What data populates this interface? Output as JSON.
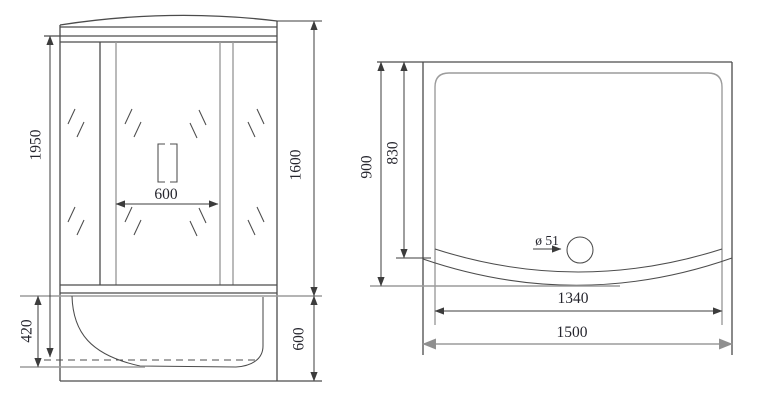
{
  "drawing": {
    "front_view": {
      "labels": {
        "total_height": "1950",
        "door_width": "600",
        "body_height": "1600",
        "tray_depth": "420",
        "tray_height": "600"
      }
    },
    "top_view": {
      "labels": {
        "outer_depth": "900",
        "inner_depth": "830",
        "drain_diameter": "ø 51",
        "inner_width": "1340",
        "outer_width": "1500"
      }
    }
  }
}
